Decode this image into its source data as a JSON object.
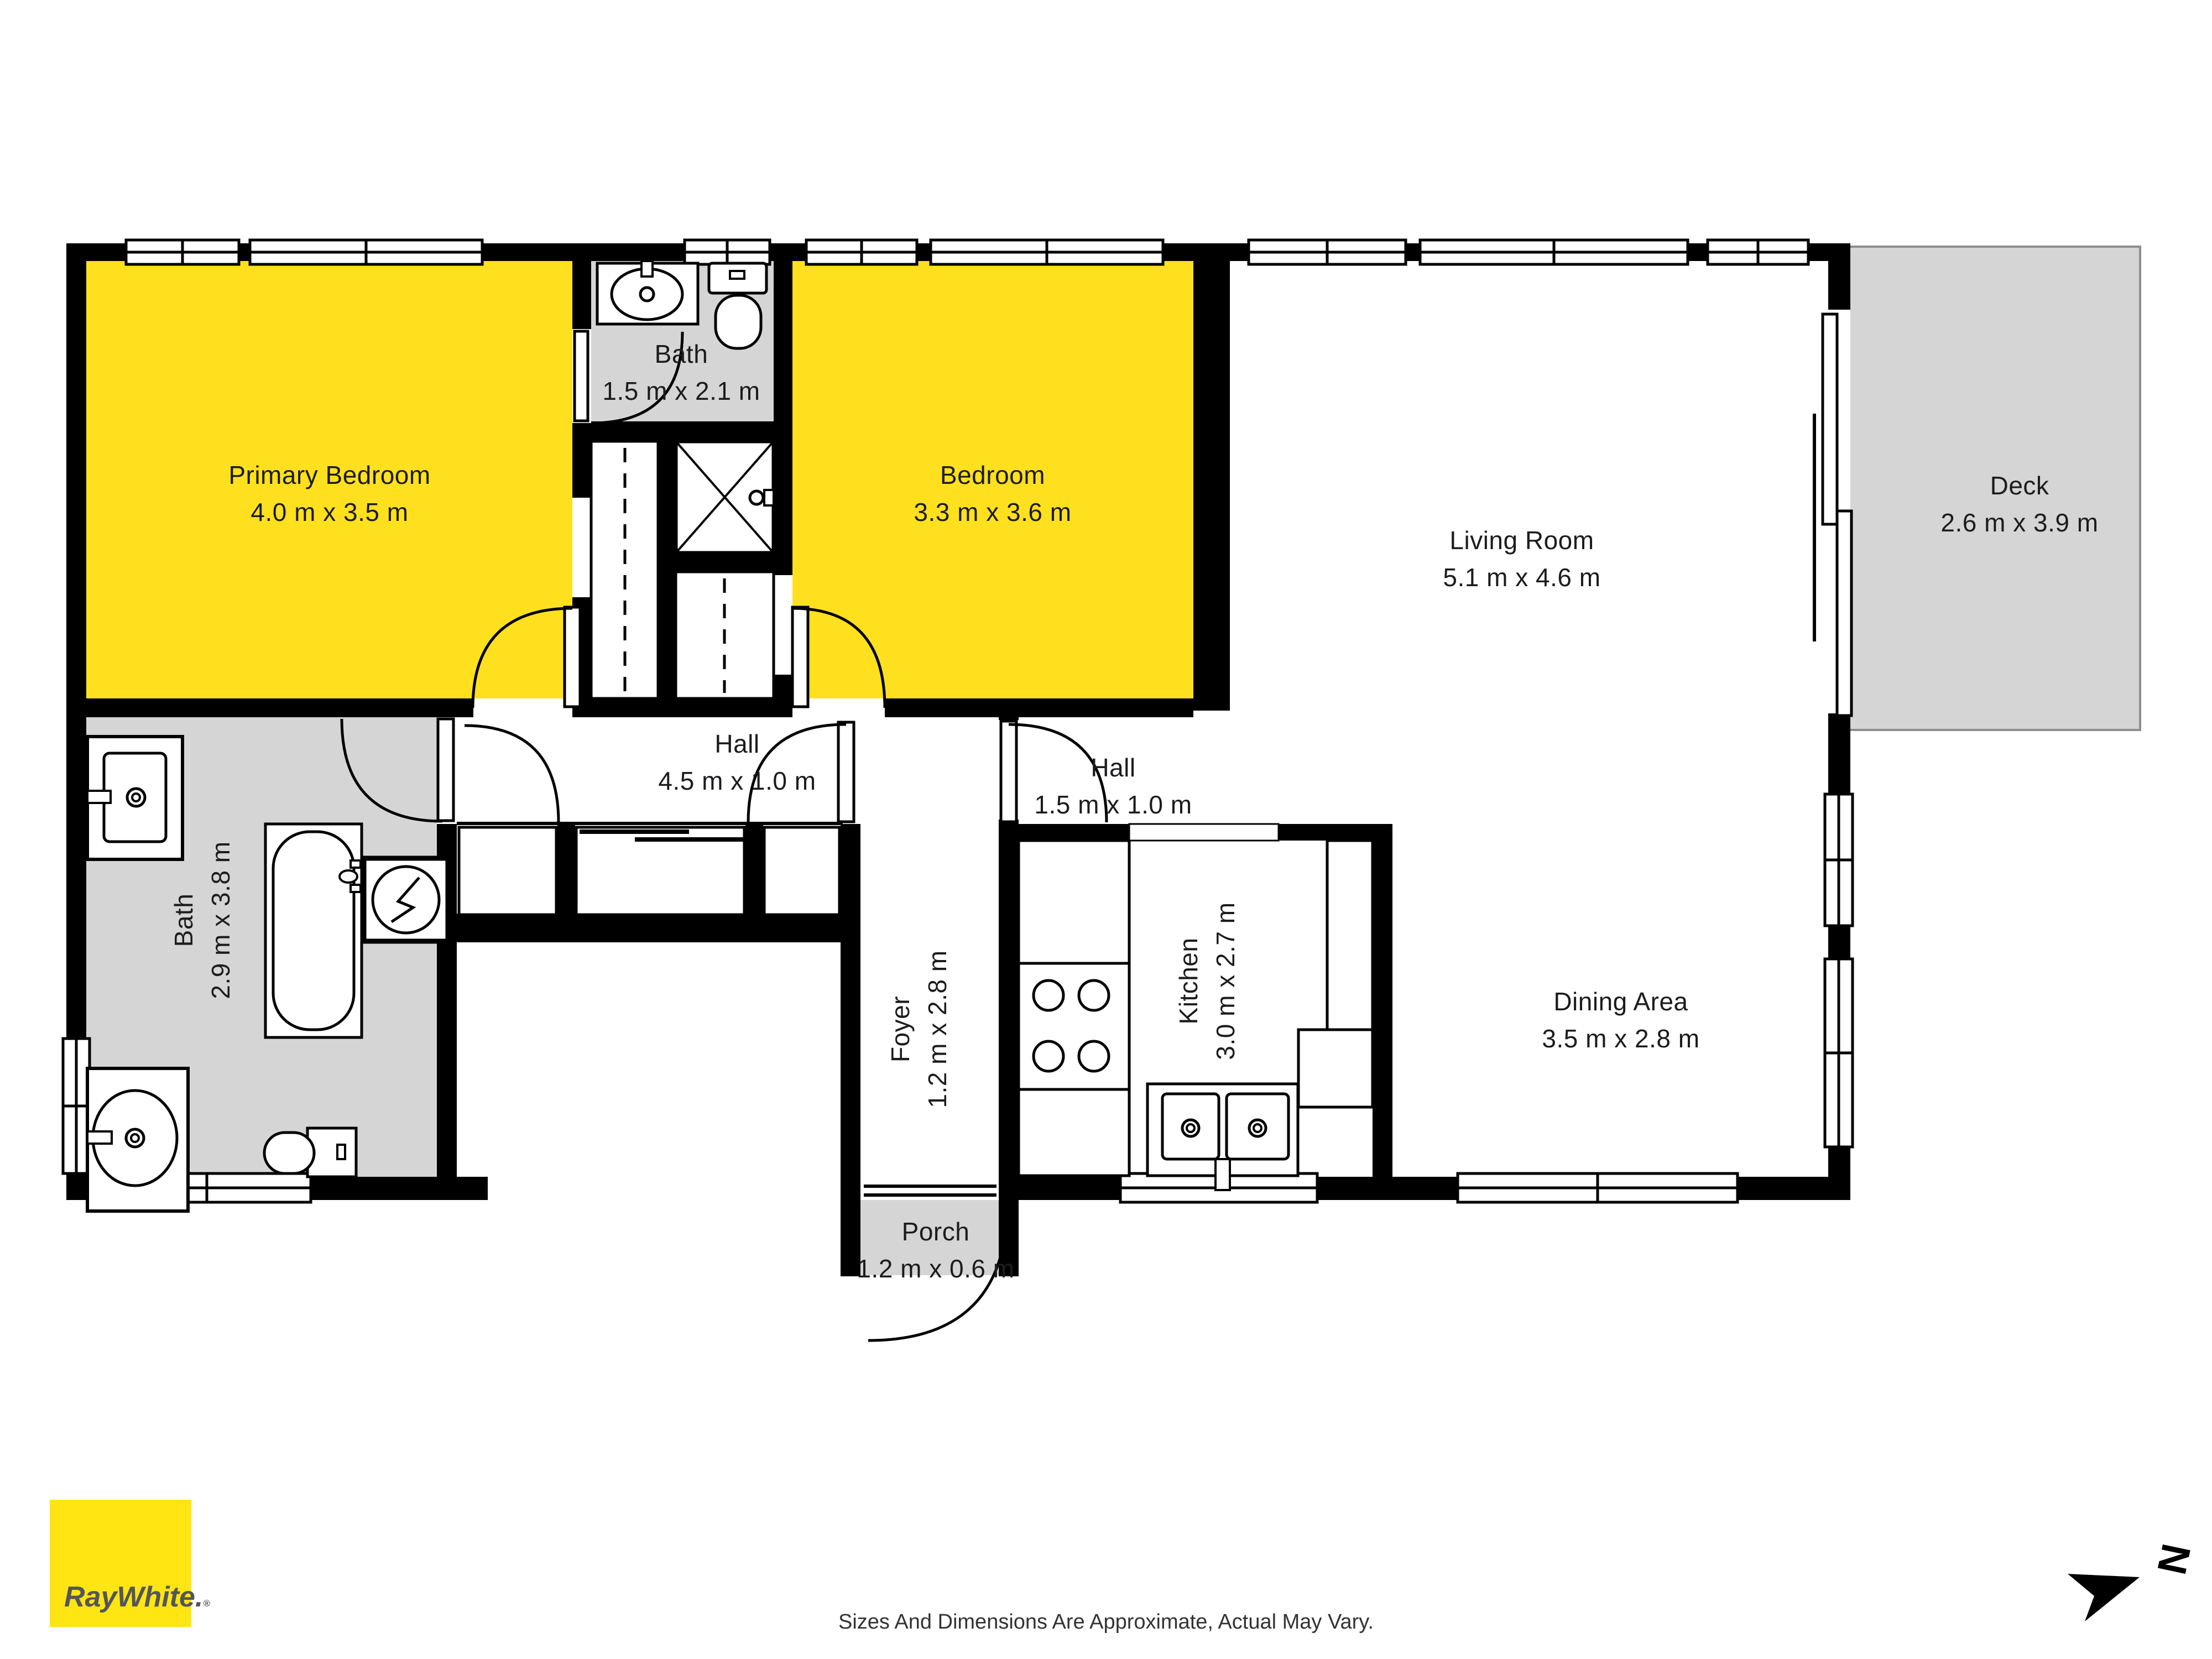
{
  "floorplan": {
    "rooms": {
      "primary_bedroom": {
        "name": "Primary Bedroom",
        "dims": "4.0 m x 3.5 m",
        "fill": "#FFE01E"
      },
      "ensuite_bath": {
        "name": "Bath",
        "dims": "1.5 m x 2.1 m",
        "fill": "#D5D5D5"
      },
      "bedroom": {
        "name": "Bedroom",
        "dims": "3.3 m x 3.6 m",
        "fill": "#FFE01E"
      },
      "living_room": {
        "name": "Living Room",
        "dims": "5.1 m x 4.6 m",
        "fill": "#FFFFFF"
      },
      "deck": {
        "name": "Deck",
        "dims": "2.6 m x 3.9 m",
        "fill": "#D5D5D5"
      },
      "hall_main": {
        "name": "Hall",
        "dims": "4.5 m x 1.0 m",
        "fill": "#FFFFFF"
      },
      "hall_small": {
        "name": "Hall",
        "dims": "1.5 m x 1.0 m",
        "fill": "#FFFFFF"
      },
      "main_bath": {
        "name": "Bath",
        "dims": "2.9 m x 3.8 m",
        "fill": "#D5D5D5"
      },
      "foyer": {
        "name": "Foyer",
        "dims": "1.2 m x 2.8 m",
        "fill": "#FFFFFF"
      },
      "kitchen": {
        "name": "Kitchen",
        "dims": "3.0 m x 2.7 m",
        "fill": "#FFFFFF"
      },
      "dining_area": {
        "name": "Dining Area",
        "dims": "3.5 m x 2.8 m",
        "fill": "#FFFFFF"
      },
      "porch": {
        "name": "Porch",
        "dims": "1.2 m x 0.6 m",
        "fill": "#D5D5D5"
      }
    },
    "compass": {
      "label": "N"
    },
    "colors": {
      "room_highlight": "#FFE01E",
      "room_secondary": "#D5D5D5",
      "wall": "#000000"
    }
  },
  "branding": {
    "logo_text": "RayWhite.",
    "registered_mark": "®",
    "logo_bg": "#FFE512",
    "logo_fg": "#54565B"
  },
  "footer": {
    "disclaimer": "Sizes And Dimensions Are Approximate, Actual May Vary."
  }
}
